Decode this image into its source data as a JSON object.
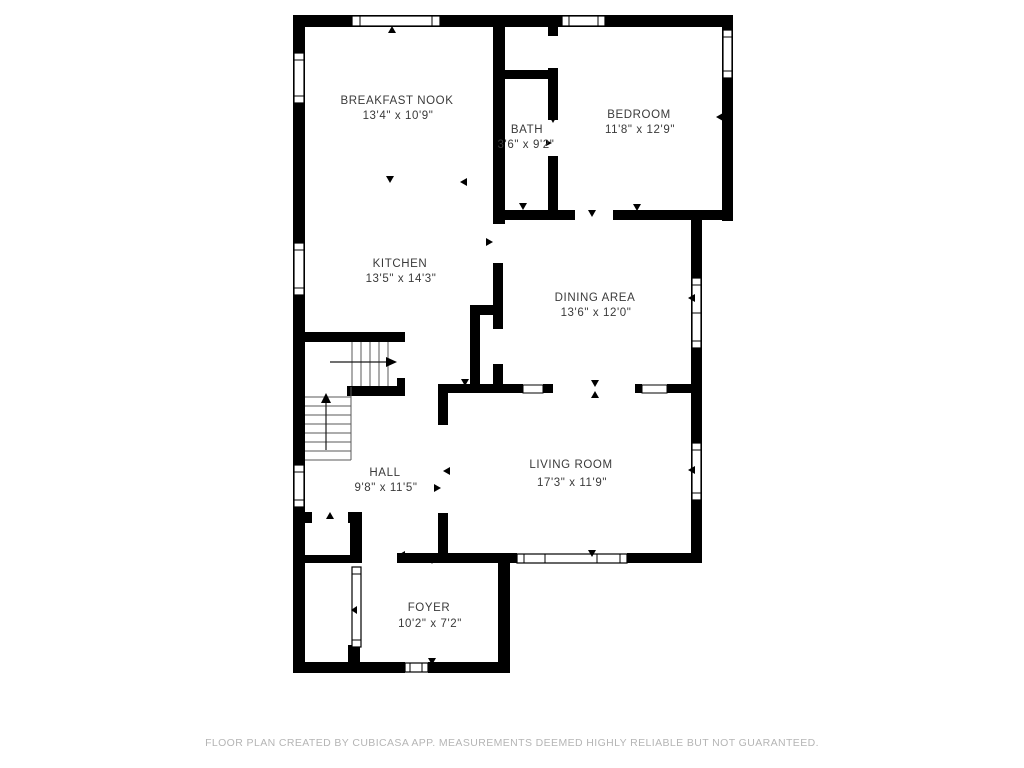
{
  "title": "Floor plan",
  "colors": {
    "wall": "#000000",
    "room_label": "#3a3a3a",
    "footer_text": "#b5b5b5",
    "background": "#ffffff"
  },
  "rooms": [
    {
      "name": "BREAKFAST NOOK",
      "dims": "13'4\" x 10'9\""
    },
    {
      "name": "BATH",
      "dims": "3'6\" x 9'2\""
    },
    {
      "name": "BEDROOM",
      "dims": "11'8\" x 12'9\""
    },
    {
      "name": "KITCHEN",
      "dims": "13'5\" x 14'3\""
    },
    {
      "name": "DINING AREA",
      "dims": "13'6\" x 12'0\""
    },
    {
      "name": "HALL",
      "dims": "9'8\" x 11'5\""
    },
    {
      "name": "LIVING ROOM",
      "dims": "17'3\" x 11'9\""
    },
    {
      "name": "FOYER",
      "dims": "10'2\" x 7'2\""
    }
  ],
  "footer": {
    "text": "FLOOR PLAN CREATED BY CUBICASA APP. MEASUREMENTS DEEMED HIGHLY RELIABLE BUT NOT GUARANTEED."
  }
}
